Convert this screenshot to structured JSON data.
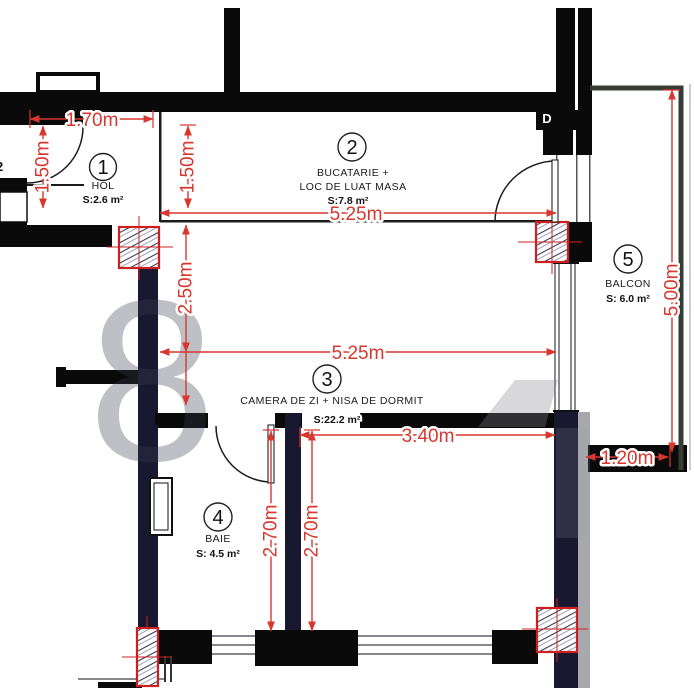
{
  "rooms": [
    {
      "number": "1",
      "name": "HOL",
      "area": "S:2.6 m²"
    },
    {
      "number": "2",
      "name_line1": "BUCATARIE +",
      "name_line2": "LOC DE LUAT MASA",
      "area": "S:7.8 m²"
    },
    {
      "number": "3",
      "name": "CAMERA DE ZI + NISA DE DORMIT",
      "area": "S:22.2 m²"
    },
    {
      "number": "4",
      "name": "BAIE",
      "area": "S: 4.5 m²"
    },
    {
      "number": "5",
      "name": "BALCON",
      "area": "S: 6.0 m²"
    }
  ],
  "dimensions": {
    "hall_width": "1.70m",
    "hall_depth": "1.50m",
    "kitchen_depth": "1.50m",
    "kitchen_width": "5.25m",
    "living_depth": "2.50m",
    "living_width": "5.25m",
    "niche_width": "3.40m",
    "bath_depth": "2.70m",
    "niche_depth": "2.70m",
    "balcony_width": "1.20m",
    "balcony_length": "5.00m"
  },
  "annotations": {
    "adjacent_unit_partial": "2",
    "utility_box": "D"
  },
  "colors": {
    "dimension_red": "#d8372f",
    "wall_black": "#0a0a0a",
    "wall_navy": "#181830",
    "column_red": "#cc2020"
  }
}
